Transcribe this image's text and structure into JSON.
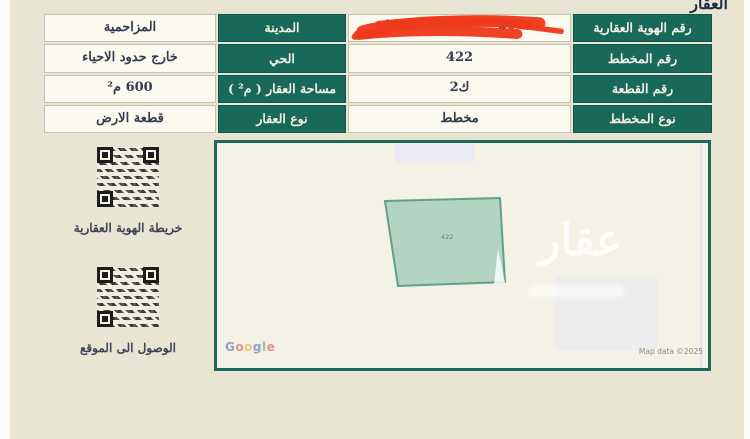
{
  "page": {
    "title": "العقار"
  },
  "table": {
    "rows": [
      {
        "label_right": "رقم الهوية العقارية",
        "value_right_redacted": {
          "left_fragment": "112",
          "right_fragment": "2004"
        },
        "label_left": "المدينة",
        "value_left": "المزاحمية"
      },
      {
        "label_right": "رقم المخطط",
        "value_right": "422",
        "label_left": "الحي",
        "value_left": "خارج حدود الاحياء"
      },
      {
        "label_right": "رقم القطعة",
        "value_right": "2ك",
        "label_left": "مساحة العقار ( م² )",
        "value_left": "600 م²"
      },
      {
        "label_right": "نوع المخطط",
        "value_right": "مخطط",
        "label_left": "نوع العقار",
        "value_left": "قطعة الارض"
      }
    ]
  },
  "qr_section": {
    "qr1_label": "خريطة الهوية العقارية",
    "qr2_label": "الوصول الى الموقع"
  },
  "map": {
    "parcel_label": "422",
    "watermark": "عقار",
    "attribution_logo_letters": [
      "G",
      "o",
      "o",
      "g",
      "l",
      "e"
    ],
    "attribution_text": "Map data ©2025"
  },
  "colors": {
    "header_green": "#19695a",
    "page_background": "#e9e5d3",
    "cell_background": "#fcfaf0",
    "map_border": "#1d6a5a",
    "parcel_fill": "#a9d3c5",
    "redaction_red": "#ee3a1b"
  }
}
